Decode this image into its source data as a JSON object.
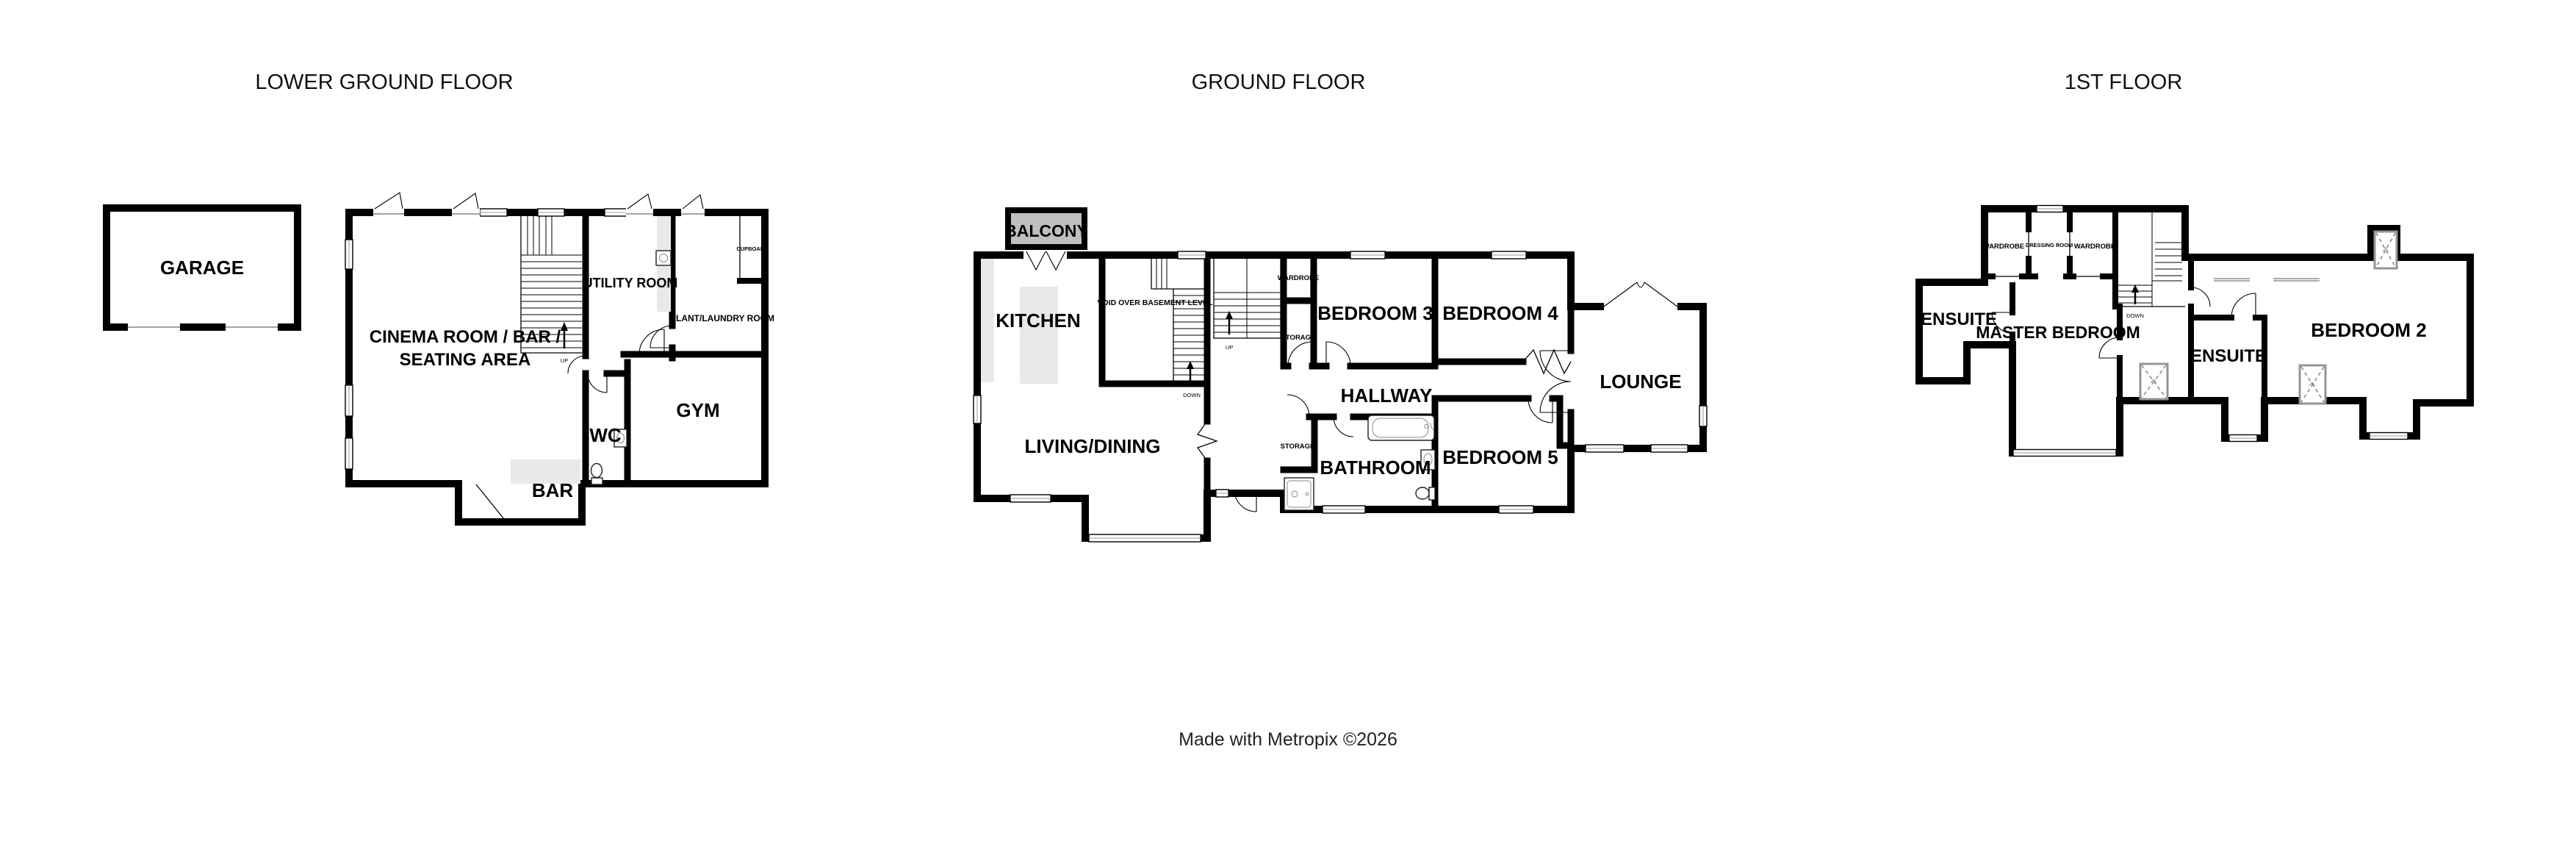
{
  "colors": {
    "wall": "#000000",
    "balcony_fill": "#bfbfbf",
    "counter_fill": "#e9e9e9",
    "window_mullion": "#9a9a9a",
    "rooflight_stroke": "#949494"
  },
  "titles": {
    "lower_ground": "LOWER GROUND FLOOR",
    "ground": "GROUND FLOOR",
    "first": "1ST FLOOR"
  },
  "footer": {
    "credit": "Made with Metropix ©2026"
  },
  "lower_ground": {
    "garage": "GARAGE",
    "cinema_line1": "CINEMA ROOM / BAR /",
    "cinema_line2": "SEATING AREA",
    "utility": "UTILITY ROOM",
    "plant": "PLANT/LAUNDRY ROOM",
    "cupboard": "CUPBOARD",
    "gym": "GYM",
    "wc": "WC",
    "bar": "BAR",
    "up": "UP"
  },
  "ground": {
    "balcony": "BALCONY",
    "kitchen": "KITCHEN",
    "void": "VOID OVER BASEMENT LEVEL",
    "living_dining": "LIVING/DINING",
    "bedroom3": "BEDROOM 3",
    "bedroom4": "BEDROOM 4",
    "bedroom5": "BEDROOM 5",
    "hallway": "HALLWAY",
    "bathroom": "BATHROOM",
    "lounge": "LOUNGE",
    "wardrobe": "WARDROBE",
    "storage_upper": "STORAGE",
    "storage_lower": "STORAGE",
    "up": "UP",
    "down": "DOWN"
  },
  "first": {
    "wardrobe_left": "WARDROBE",
    "dressing_room": "DRESSING ROOM",
    "wardrobe_right": "WARDROBE",
    "ensuite_master": "ENSUITE",
    "master_bedroom": "MASTER BEDROOM",
    "ensuite2": "ENSUITE",
    "bedroom2": "BEDROOM 2",
    "down": "DOWN"
  }
}
